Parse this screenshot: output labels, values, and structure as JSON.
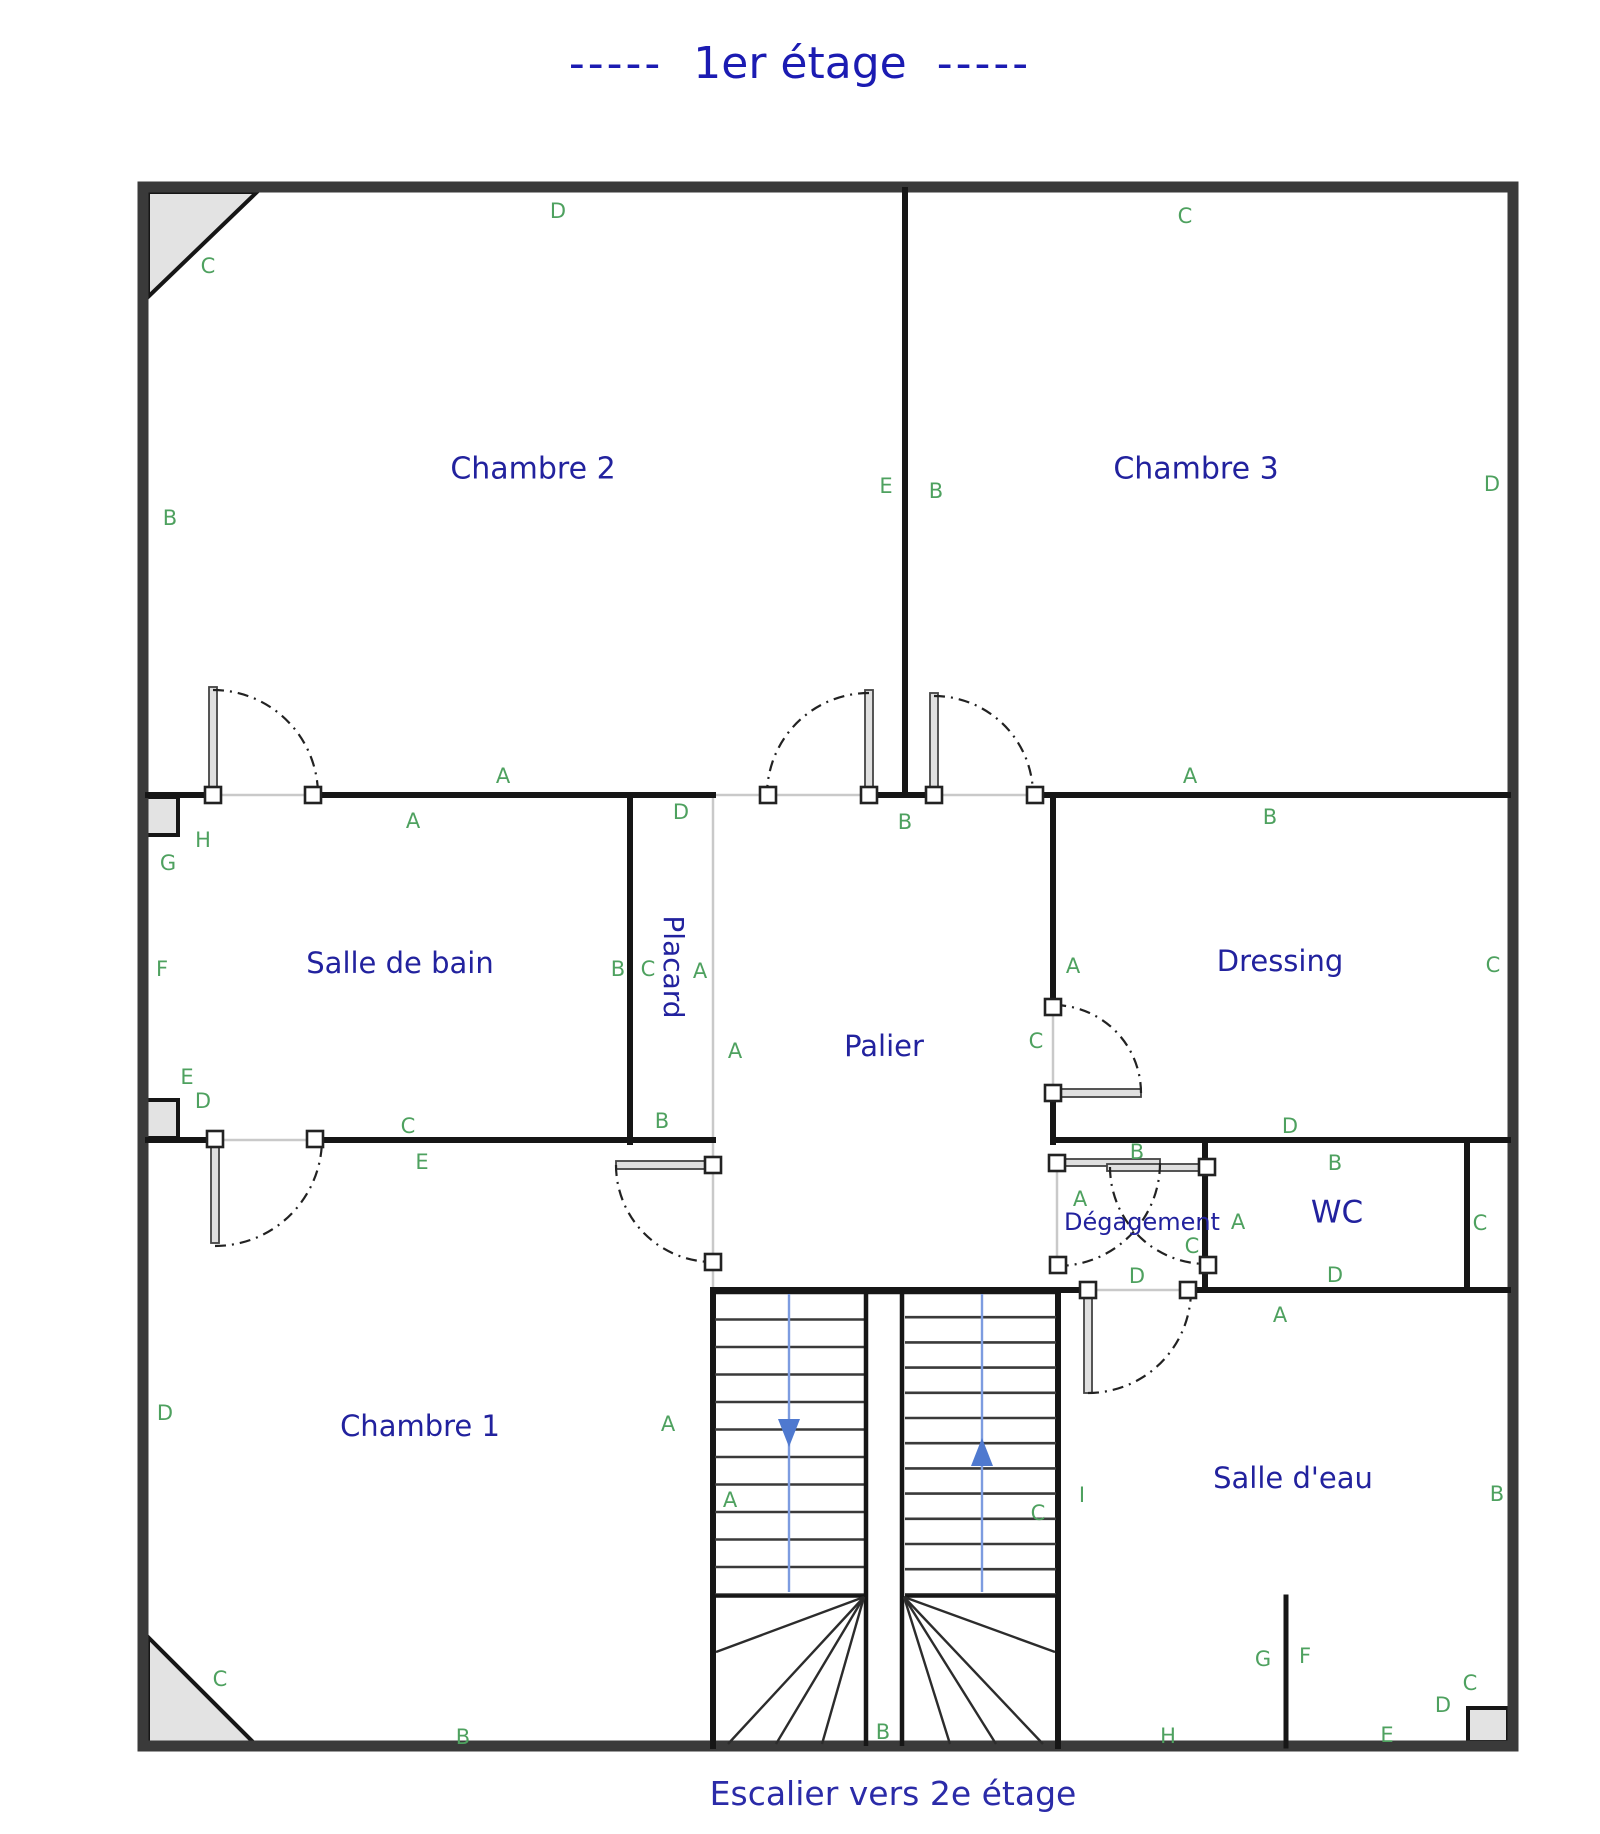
{
  "title": {
    "prefix": "-----",
    "text": "1er étage",
    "suffix": "-----"
  },
  "caption": "Escalier vers 2e étage",
  "colors": {
    "room_label": "#22229e",
    "marker": "#4ea15f",
    "title": "#1b1bb2",
    "outer_wall": "#3a3a3a",
    "inner_wall": "#161616",
    "stair_arrow_blue": "#5b84d6"
  },
  "rooms": [
    {
      "id": "chambre-2",
      "label": "Chambre 2",
      "x": 533,
      "y": 470,
      "size": 30,
      "rotate": 0
    },
    {
      "id": "chambre-3",
      "label": "Chambre 3",
      "x": 1196,
      "y": 470,
      "size": 30,
      "rotate": 0
    },
    {
      "id": "salle-de-bain",
      "label": "Salle de bain",
      "x": 400,
      "y": 965,
      "size": 29,
      "rotate": 0
    },
    {
      "id": "placard",
      "label": "Placard",
      "x": 672,
      "y": 967,
      "size": 28,
      "rotate": 90
    },
    {
      "id": "palier",
      "label": "Palier",
      "x": 884,
      "y": 1048,
      "size": 29,
      "rotate": 0
    },
    {
      "id": "dressing",
      "label": "Dressing",
      "x": 1280,
      "y": 963,
      "size": 29,
      "rotate": 0
    },
    {
      "id": "degagement",
      "label": "Dégagement",
      "x": 1142,
      "y": 1223,
      "size": 24,
      "rotate": 0
    },
    {
      "id": "wc",
      "label": "WC",
      "x": 1337,
      "y": 1214,
      "size": 31,
      "rotate": 0
    },
    {
      "id": "chambre-1",
      "label": "Chambre 1",
      "x": 420,
      "y": 1428,
      "size": 29,
      "rotate": 0
    },
    {
      "id": "salle-d-eau",
      "label": "Salle d'eau",
      "x": 1293,
      "y": 1480,
      "size": 29,
      "rotate": 0
    }
  ],
  "markers": [
    {
      "t": "C",
      "x": 208,
      "y": 267
    },
    {
      "t": "D",
      "x": 558,
      "y": 212
    },
    {
      "t": "C",
      "x": 1185,
      "y": 217
    },
    {
      "t": "B",
      "x": 170,
      "y": 519
    },
    {
      "t": "D",
      "x": 1492,
      "y": 485
    },
    {
      "t": "E",
      "x": 886,
      "y": 487
    },
    {
      "t": "B",
      "x": 936,
      "y": 492
    },
    {
      "t": "A",
      "x": 503,
      "y": 777
    },
    {
      "t": "A",
      "x": 413,
      "y": 822
    },
    {
      "t": "A",
      "x": 1190,
      "y": 777
    },
    {
      "t": "B",
      "x": 1270,
      "y": 818
    },
    {
      "t": "D",
      "x": 681,
      "y": 813
    },
    {
      "t": "B",
      "x": 905,
      "y": 823
    },
    {
      "t": "H",
      "x": 203,
      "y": 841
    },
    {
      "t": "G",
      "x": 168,
      "y": 864
    },
    {
      "t": "F",
      "x": 162,
      "y": 970
    },
    {
      "t": "B",
      "x": 618,
      "y": 970
    },
    {
      "t": "C",
      "x": 648,
      "y": 970
    },
    {
      "t": "A",
      "x": 700,
      "y": 972
    },
    {
      "t": "A",
      "x": 735,
      "y": 1052
    },
    {
      "t": "A",
      "x": 1073,
      "y": 967
    },
    {
      "t": "C",
      "x": 1493,
      "y": 966
    },
    {
      "t": "C",
      "x": 1036,
      "y": 1042
    },
    {
      "t": "B",
      "x": 662,
      "y": 1122
    },
    {
      "t": "D",
      "x": 1290,
      "y": 1127
    },
    {
      "t": "E",
      "x": 187,
      "y": 1078
    },
    {
      "t": "D",
      "x": 203,
      "y": 1102
    },
    {
      "t": "C",
      "x": 408,
      "y": 1127
    },
    {
      "t": "E",
      "x": 422,
      "y": 1163
    },
    {
      "t": "B",
      "x": 1137,
      "y": 1153
    },
    {
      "t": "A",
      "x": 1080,
      "y": 1200
    },
    {
      "t": "A",
      "x": 1238,
      "y": 1223
    },
    {
      "t": "C",
      "x": 1192,
      "y": 1247
    },
    {
      "t": "D",
      "x": 1137,
      "y": 1277
    },
    {
      "t": "B",
      "x": 1335,
      "y": 1164
    },
    {
      "t": "C",
      "x": 1480,
      "y": 1224
    },
    {
      "t": "D",
      "x": 1335,
      "y": 1276
    },
    {
      "t": "A",
      "x": 1280,
      "y": 1316
    },
    {
      "t": "D",
      "x": 165,
      "y": 1414
    },
    {
      "t": "A",
      "x": 668,
      "y": 1425
    },
    {
      "t": "A",
      "x": 730,
      "y": 1501
    },
    {
      "t": "C",
      "x": 1038,
      "y": 1514
    },
    {
      "t": "I",
      "x": 1082,
      "y": 1496
    },
    {
      "t": "B",
      "x": 1497,
      "y": 1495
    },
    {
      "t": "G",
      "x": 1263,
      "y": 1660
    },
    {
      "t": "F",
      "x": 1305,
      "y": 1657
    },
    {
      "t": "C",
      "x": 220,
      "y": 1680
    },
    {
      "t": "C",
      "x": 1470,
      "y": 1684
    },
    {
      "t": "D",
      "x": 1443,
      "y": 1706
    },
    {
      "t": "B",
      "x": 463,
      "y": 1738
    },
    {
      "t": "B",
      "x": 883,
      "y": 1733
    },
    {
      "t": "H",
      "x": 1168,
      "y": 1737
    },
    {
      "t": "E",
      "x": 1387,
      "y": 1736
    }
  ]
}
